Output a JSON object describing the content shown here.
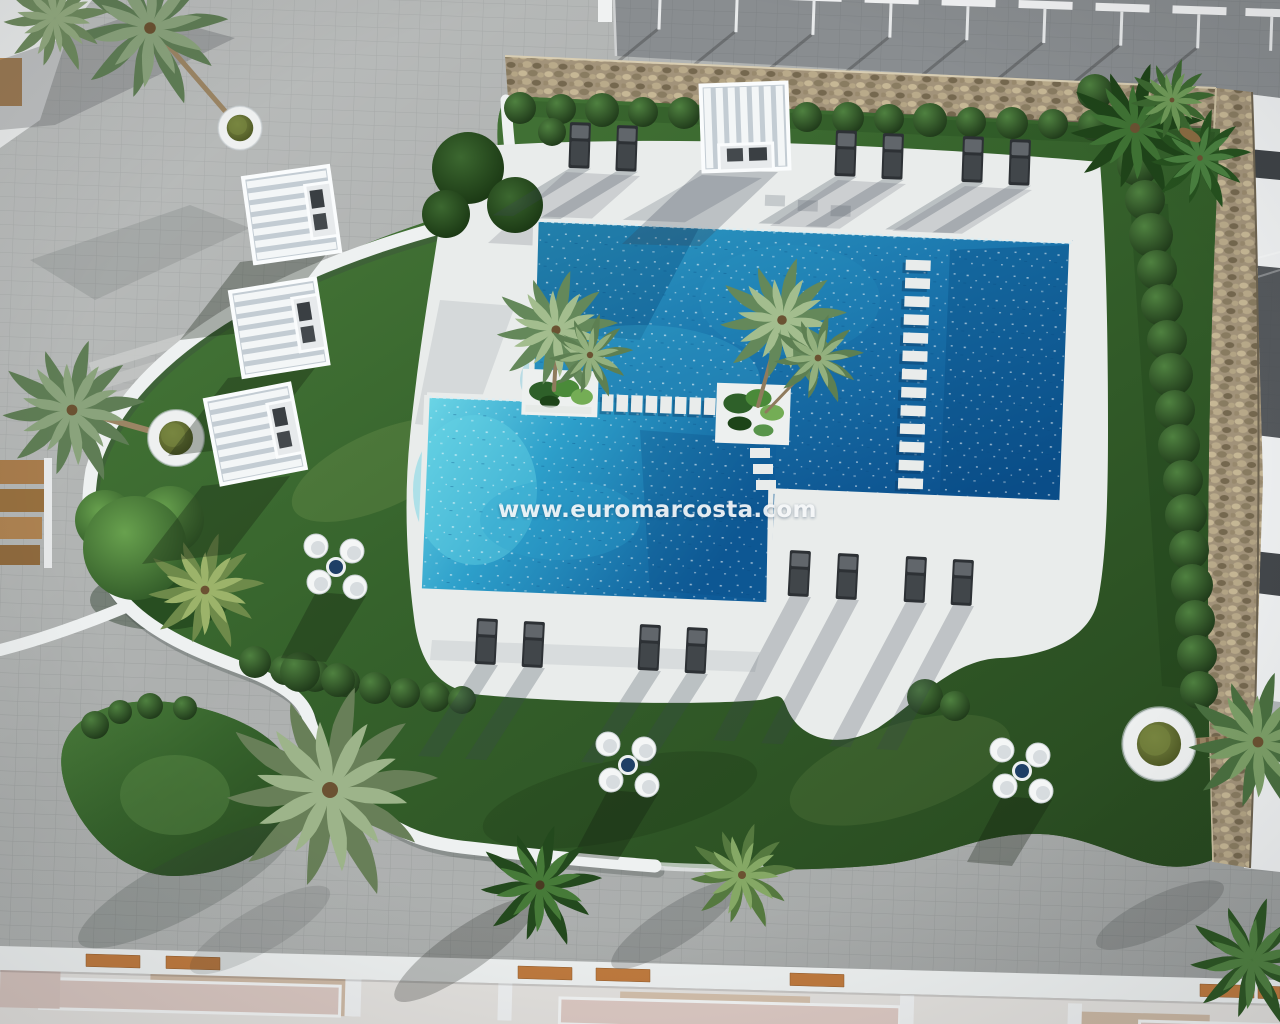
{
  "watermark": {
    "text": "www.euromarcosta.com"
  },
  "palette": {
    "pavement": "#adb0af",
    "deck": "#e9eceb",
    "lawn": "#36632c",
    "pool_deep": "#0b4f8c",
    "pool_light": "#6cd6e6",
    "stone": "#a2937a",
    "bush": "#1c3517",
    "lounger": "#2d3135",
    "white_structure": "#eef1f1",
    "roof": "#898d90",
    "wood": "#bf7a3e",
    "terrace_pink": "#d9c7c1",
    "watermark_color": "#f5f7f9"
  }
}
